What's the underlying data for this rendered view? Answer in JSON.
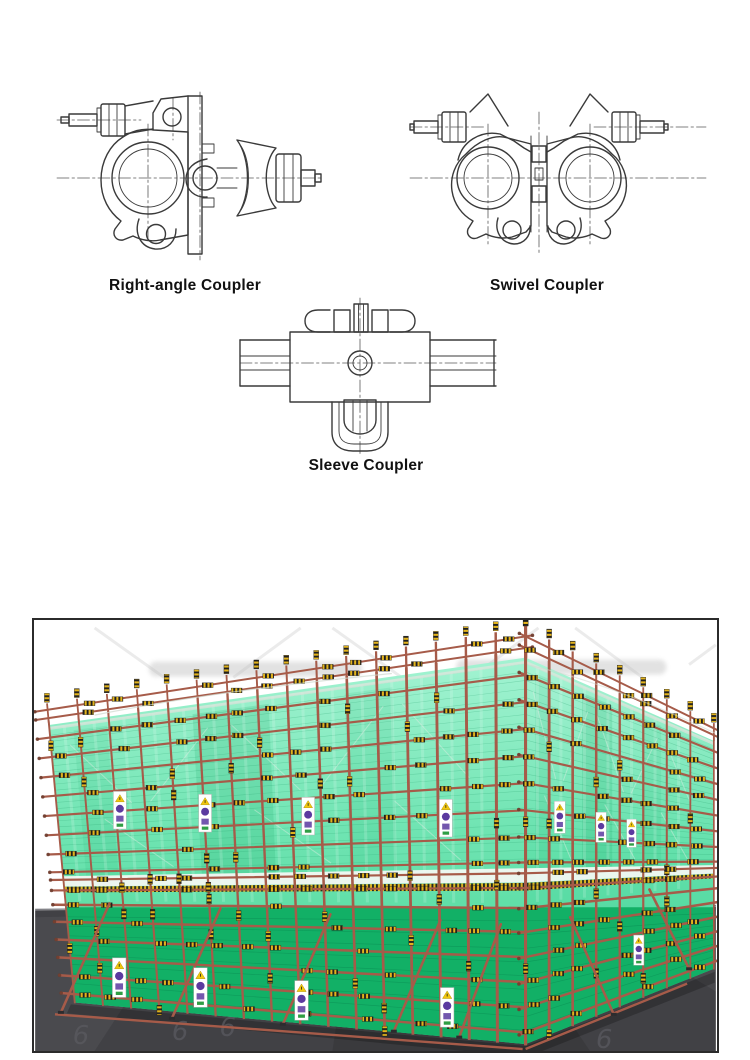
{
  "figures": [
    {
      "id": "right-angle",
      "label": "Right-angle Coupler"
    },
    {
      "id": "swivel",
      "label": "Swivel Coupler"
    },
    {
      "id": "sleeve",
      "label": "Sleeve Coupler"
    }
  ],
  "render": {
    "description": "3D model of a building scaffold wrapped in green safety mesh with steel tube couplers",
    "watermark_glyph": "6",
    "sign_elements": [
      "warning-triangle",
      "mandatory-circle",
      "info-plate",
      "green-plate"
    ]
  },
  "colors": {
    "page_bg": "#ffffff",
    "line": "#3a3a3a",
    "centerline": "#5a5a5a",
    "label": "#111111",
    "scene_border": "#2b2b2b",
    "ground": "#414145",
    "mesh_top": "#a3f3d2",
    "mesh_mid": "#52da9e",
    "mesh_dark": "#12b066",
    "mesh_line": "#27a06d",
    "tube": "#a65b49",
    "tube_dark": "#6f3d2f",
    "stripe_yellow": "#e2b31c",
    "stripe_black": "#1e1e1e",
    "walkway": "#f5f7f4",
    "sign_bg": "#ffffff",
    "sign_yellow": "#f2c70e",
    "sign_purple": "#5b3aa0",
    "sign_green": "#2f9e44",
    "watermark": "#d8d8d8"
  }
}
